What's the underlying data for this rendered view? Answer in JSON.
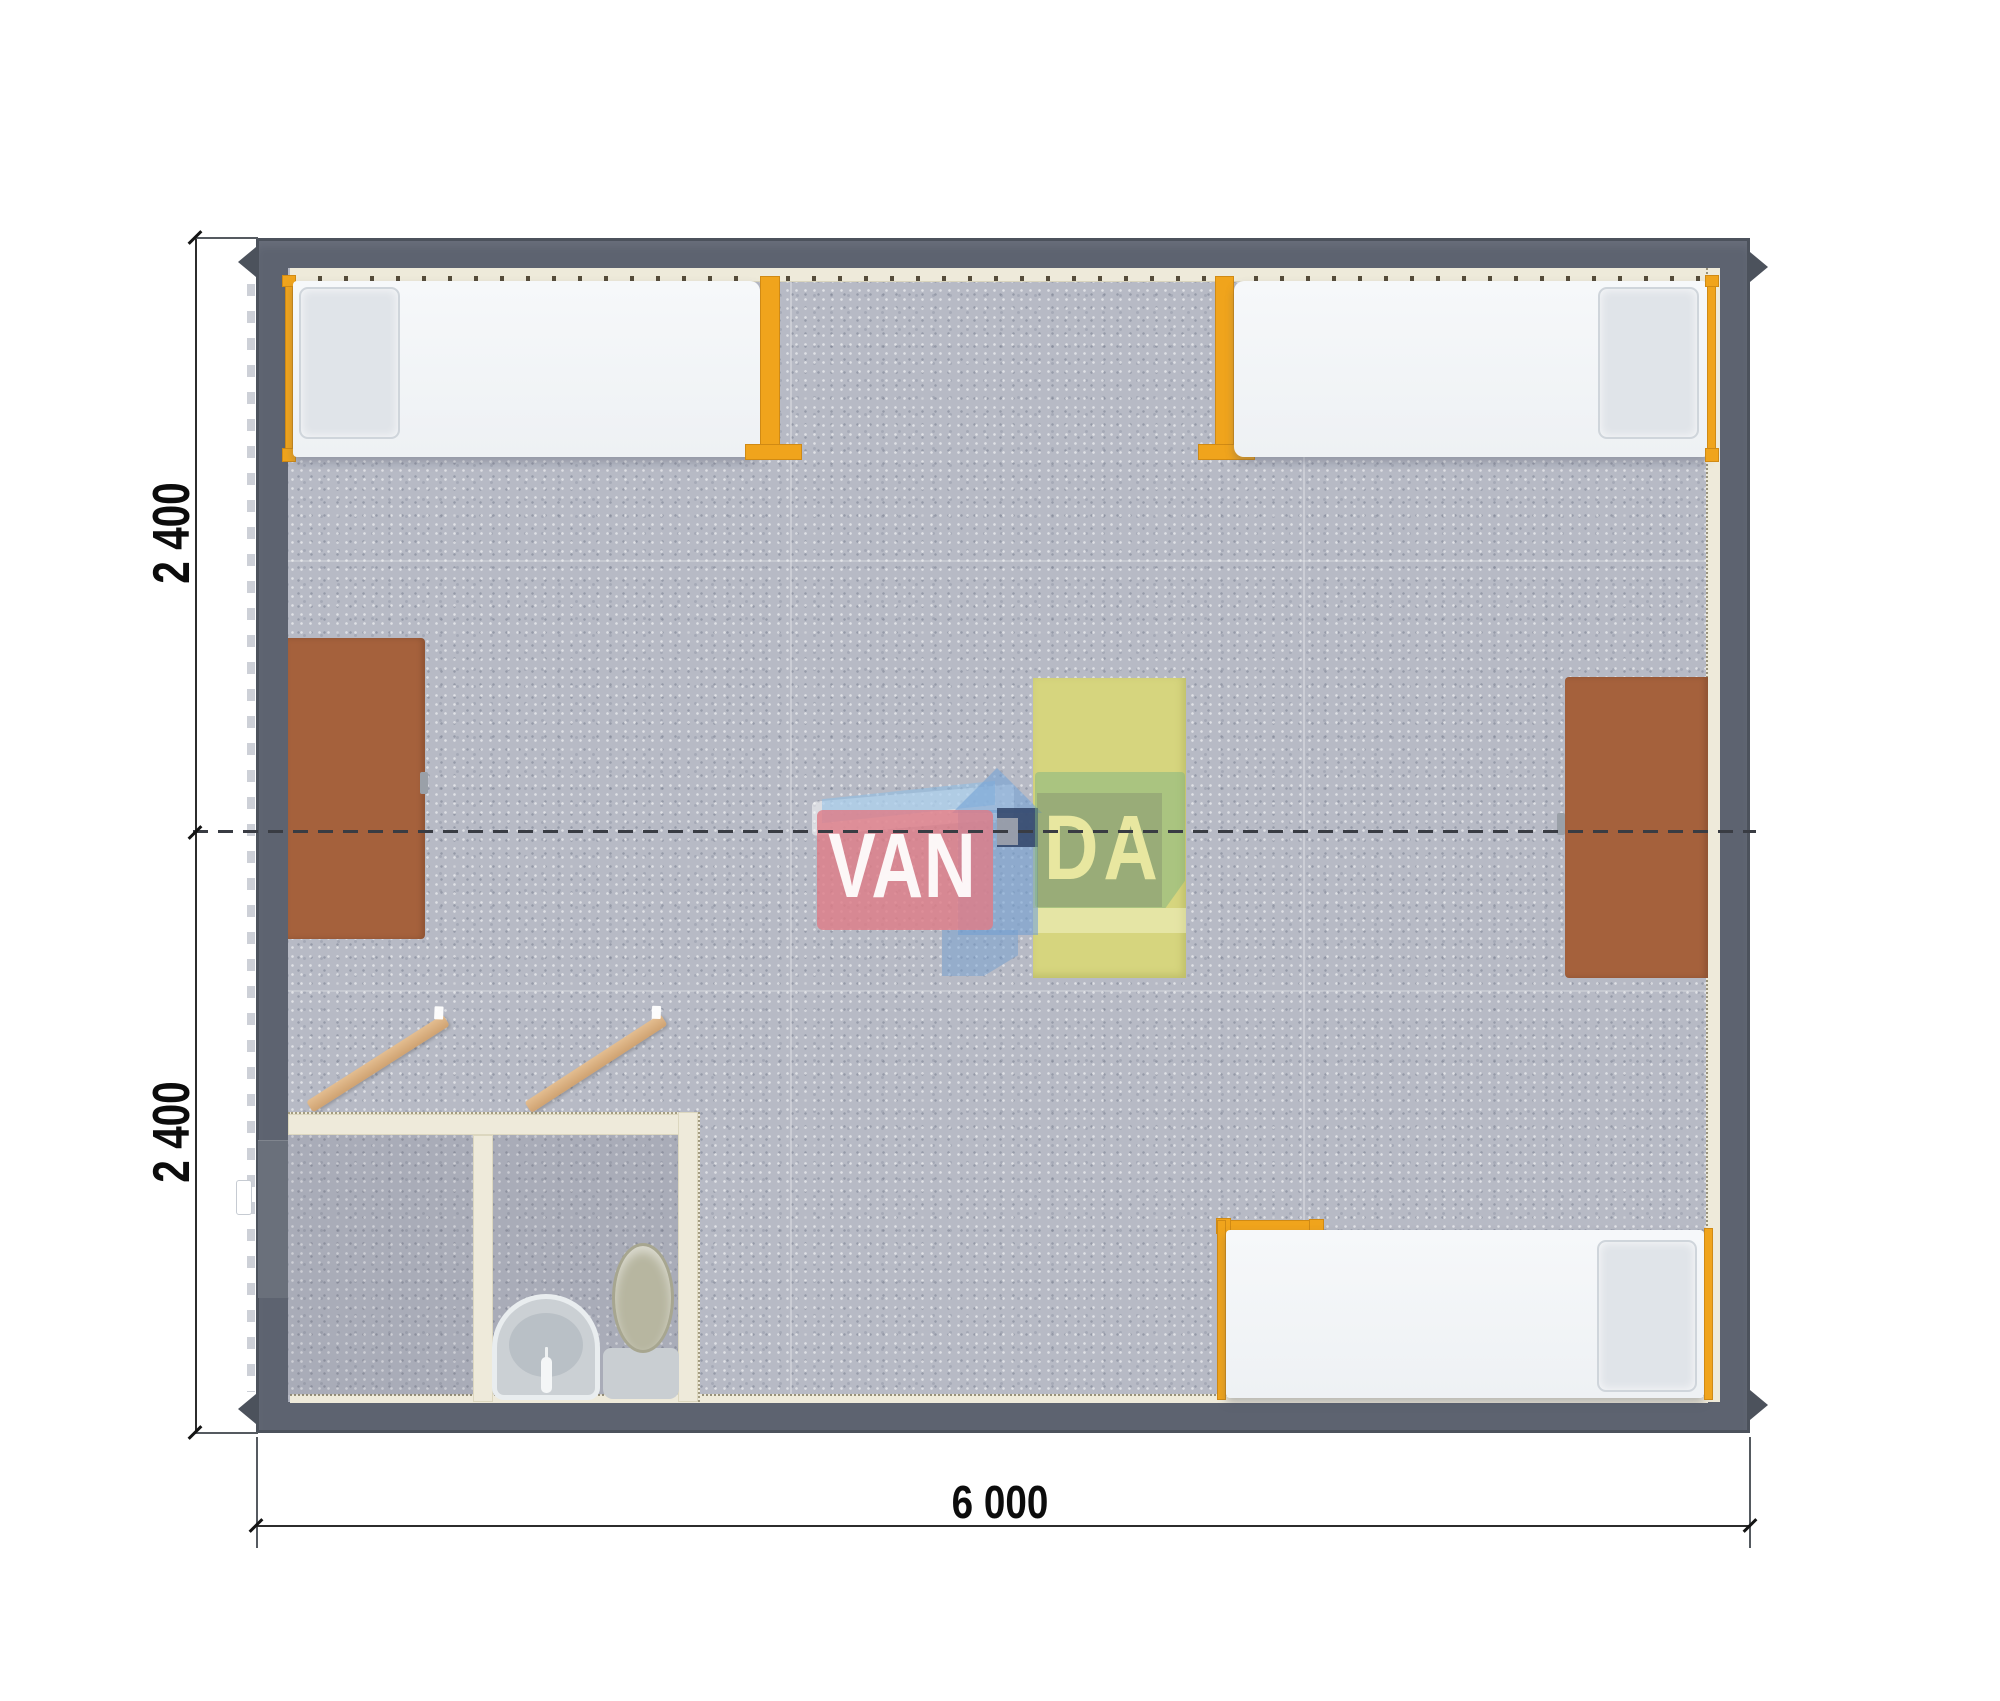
{
  "scene": {
    "kind": "floor-plan-render",
    "modules": 2
  },
  "dimensions": {
    "left_top": "2 400",
    "left_bottom": "2 400",
    "bottom": "6 000"
  },
  "watermark": {
    "text_left": "VAN",
    "text_right": "DA"
  },
  "colors": {
    "wall": "#5d6370",
    "wall_dark": "#4c525c",
    "carpet": "#b7bac5",
    "trim_cream": "#eeeada",
    "accent_orange": "#f0a41c",
    "desk_brown": "#a5613c",
    "table_yellow": "#d6d57e",
    "bed_white": "#f3f5f7",
    "logo_pink": "#de7d87",
    "logo_blue": "#73a0d2",
    "logo_green": "#7db482",
    "logo_navy": "#33476b"
  },
  "furniture_counts": {
    "single_beds": 3,
    "desks": 2,
    "tables": 1,
    "toilets": 1,
    "sinks": 1
  }
}
